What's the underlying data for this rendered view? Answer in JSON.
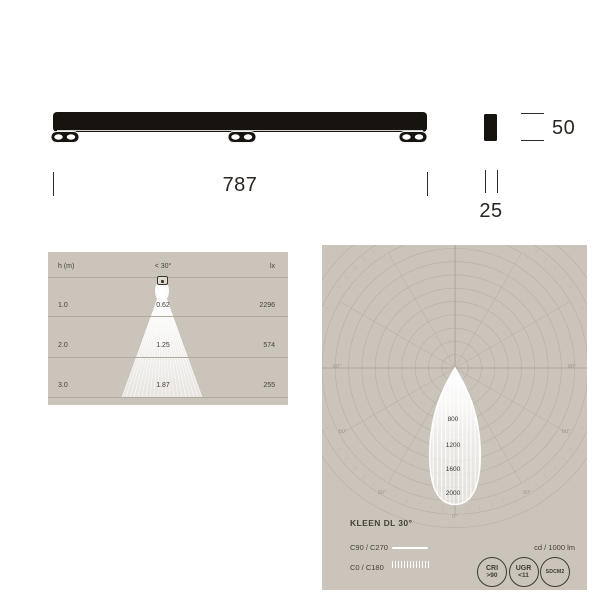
{
  "page": {
    "background": "#ffffff",
    "panel_background": "#cbc4bb",
    "panel_line_color": "#b0a99e",
    "ink": "#292521",
    "curve_color": "#ffffff"
  },
  "drawing": {
    "length_label": "787",
    "height_label": "50",
    "width_label": "25"
  },
  "product": {
    "name": "KLEEN DL 30°"
  },
  "chart_data": [
    {
      "type": "area",
      "title": "Illuminance cone diagram",
      "col_headers": [
        "h (m)",
        "< 30°",
        "lx"
      ],
      "rows": [
        {
          "h": "1.0",
          "diameter_m": "0.62",
          "lx": "2296"
        },
        {
          "h": "2.0",
          "diameter_m": "1.25",
          "lx": "574"
        },
        {
          "h": "3.0",
          "diameter_m": "1.87",
          "lx": "255"
        }
      ],
      "beam_angle_deg": 30
    },
    {
      "type": "line",
      "subtype": "polar-photometric",
      "title": "KLEEN DL 30°",
      "unit": "cd / 1000 lm",
      "rings": {
        "step_cd": 200,
        "max_labeled_cd": 2000
      },
      "cd_ring_labels": [
        "800",
        "1200",
        "1600",
        "2000"
      ],
      "angle_labels": [
        "90°",
        "60°",
        "30°",
        "0°",
        "30°",
        "60°",
        "90°"
      ],
      "grid": {
        "radial_step_deg": 30,
        "tick_step_deg": 5
      },
      "series": [
        {
          "name": "C90 / C270",
          "style": "solid"
        },
        {
          "name": "C0 / C180",
          "style": "hatched"
        }
      ],
      "beam": {
        "angle_deg": 30,
        "peak_cd_per_1000lm": 2050
      }
    }
  ],
  "badges": [
    {
      "line1": "CRI",
      "line2": ">90"
    },
    {
      "line1": "UGR",
      "line2": "<11"
    },
    {
      "line1": "SDCM2"
    }
  ]
}
